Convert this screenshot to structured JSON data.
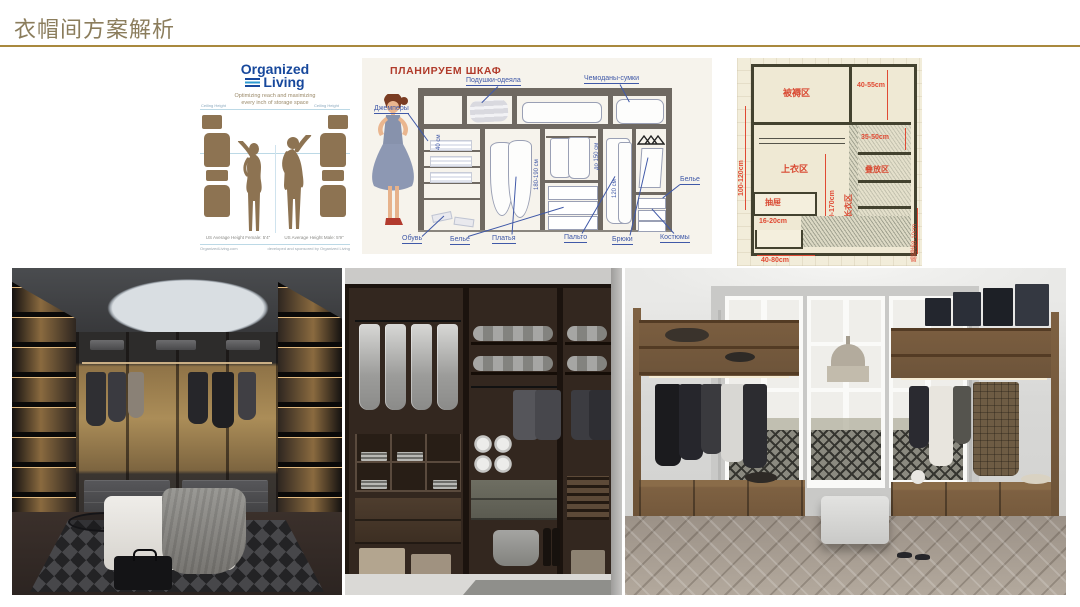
{
  "page": {
    "title": "衣帽间方案解析"
  },
  "ol": {
    "brand_top": "Organized",
    "brand_bottom": "Living",
    "tagline_1": "Optimizing reach and maximizing",
    "tagline_2": "every inch of storage space",
    "ceiling_left": "Ceiling Height",
    "ceiling_right": "Ceiling Height",
    "caption_female": "US Average Height Female: 5'4\"",
    "caption_male": "US Average Height Male: 5'9\"",
    "footer_left": "OrganizedLiving.com",
    "footer_right": "developed and sponsored by Organized Living"
  },
  "ru": {
    "title": "ПЛАНИРУЕМ ШКАФ",
    "pillows": "Подушки-одеяла",
    "suitcases": "Чемоданы-сумки",
    "jumpers": "Джемперы",
    "shoes": "Обувь",
    "linen": "Белье",
    "dresses": "Платья",
    "coats": "Пальто",
    "trousers": "Брюки",
    "suits": "Костюмы",
    "linen_right": "Белье",
    "dim_shelf": "40 см",
    "dim_dresses": "180-190 см",
    "dim_shirts": "до 150 см",
    "dim_coats": "120 см"
  },
  "cn": {
    "zone_bedding": "被褥区",
    "zone_tops": "上衣区",
    "zone_stack": "叠放区",
    "zone_long": "长衣区",
    "zone_drawer": "抽屉",
    "dim_top": "40-55cm",
    "dim_right": "35-50cm",
    "dim_left": "100-120cm",
    "dim_long": "140-170cm",
    "dim_drawer_h": "16-20cm",
    "dim_bottom": "40-80cm",
    "dim_skirting": "踢脚线8-10cm"
  }
}
